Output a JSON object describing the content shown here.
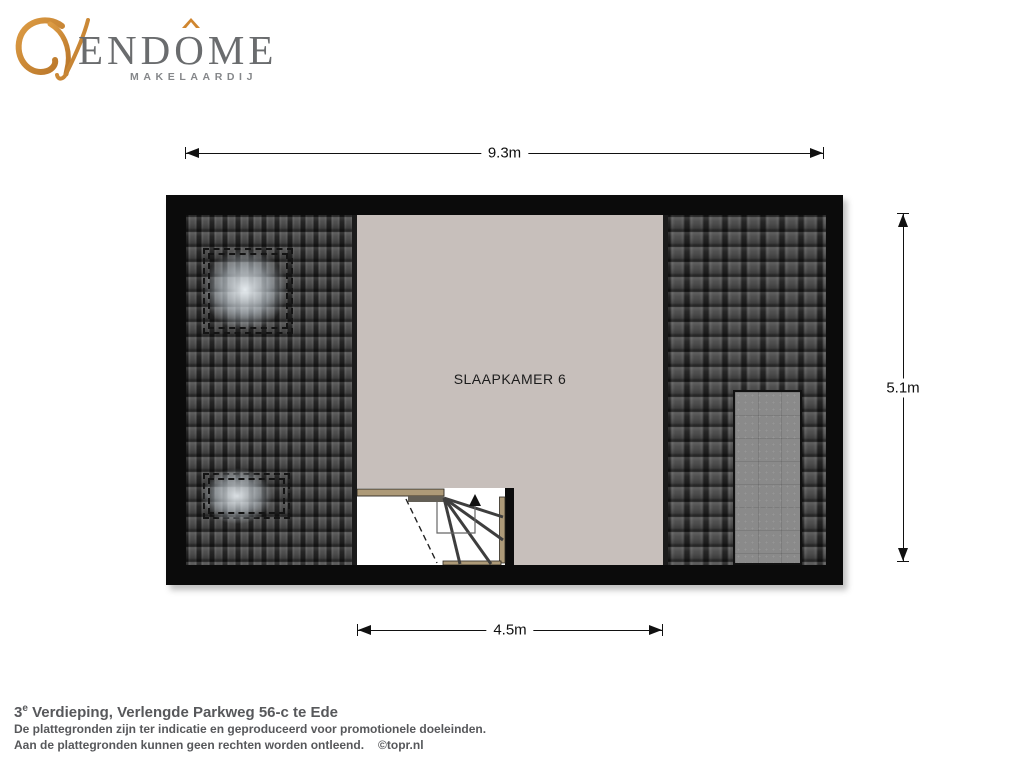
{
  "logo": {
    "brand_part1": "END",
    "brand_o": "O",
    "brand_part2": "ME",
    "subtitle": "MAKELAARDIJ",
    "accent_color": "#d0862f",
    "text_color": "#6a6c6e"
  },
  "plan": {
    "room_label": "SLAAPKAMER 6",
    "dimensions": {
      "top": "9.3m",
      "right": "5.1m",
      "bottom": "4.5m"
    }
  },
  "footer": {
    "floor_number": "3",
    "floor_suffix": "e",
    "title_rest": " Verdieping, Verlengde Parkweg 56-c te Ede",
    "disclaimer_line1": "De plattegronden zijn ter indicatie en geproduceerd voor promotionele doeleinden.",
    "disclaimer_line2": "Aan de plattegronden kunnen geen rechten worden ontleend.",
    "credit": "©topr.nl"
  },
  "colors": {
    "wall": "#0b0b0b",
    "roof_tile": "#4e4e4e",
    "room_floor": "#c7bfbb",
    "dormer": "#8a8a8a",
    "handrail": "#ad9a78"
  }
}
